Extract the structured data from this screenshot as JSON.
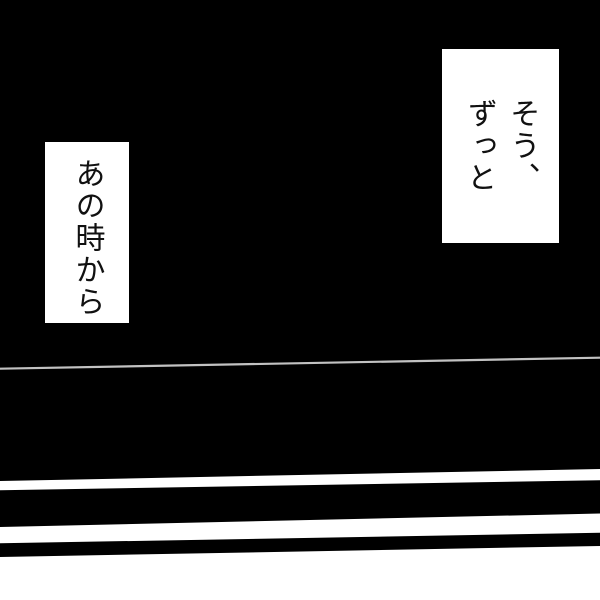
{
  "panel": {
    "type": "manga-panel",
    "background_color": "#000000",
    "bubble_color": "#ffffff",
    "speed_line_color": "#c2c2c2",
    "stripe_color": "#ffffff",
    "band_color": "#000000"
  },
  "bubbles": [
    {
      "name": "caption-top-right",
      "text": "そう、ずっと",
      "lines": [
        "そう、",
        "ずっと"
      ]
    },
    {
      "name": "caption-left",
      "text": "あの時から",
      "lines": [
        "あの時から"
      ]
    }
  ]
}
